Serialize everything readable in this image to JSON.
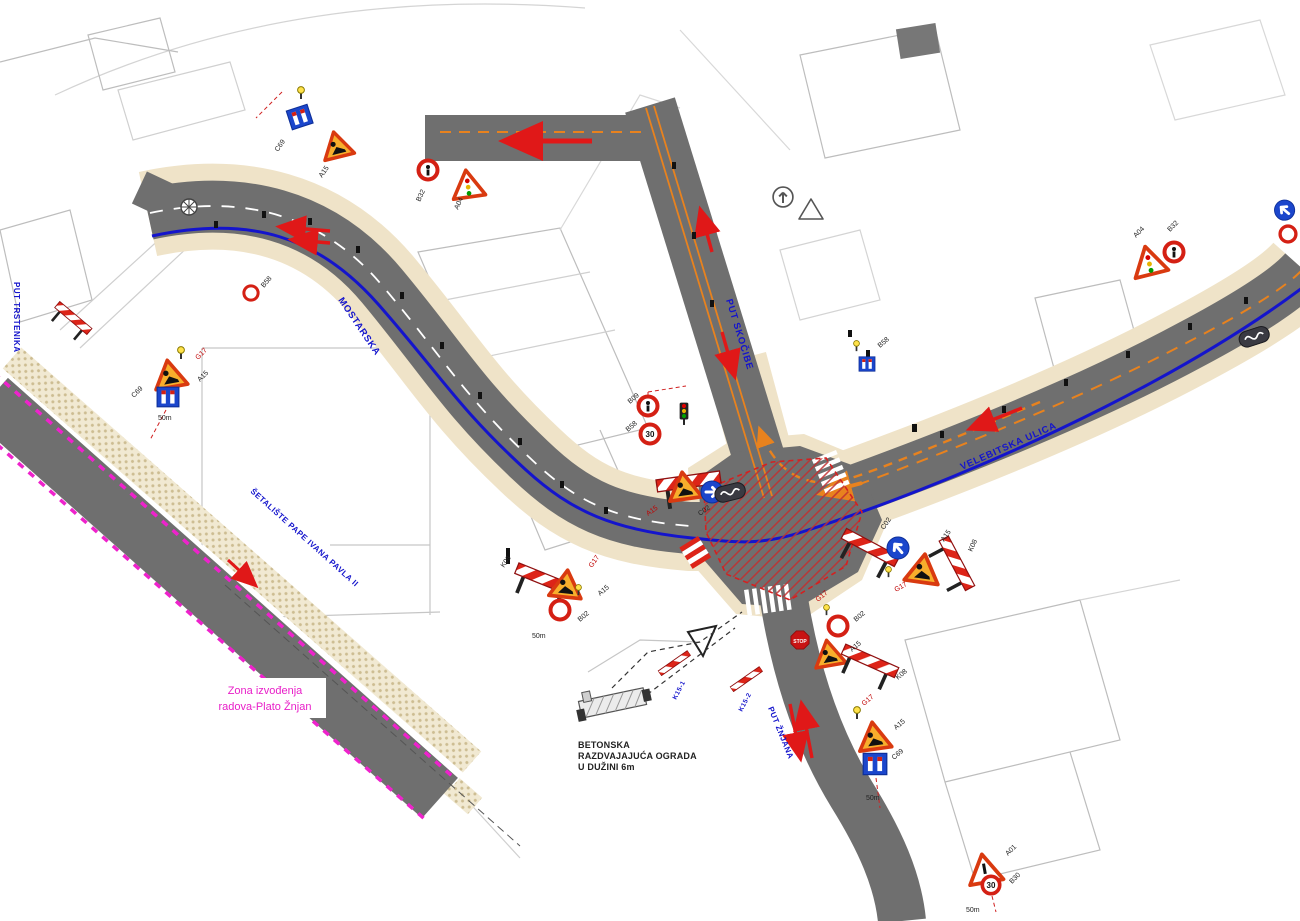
{
  "labels": {
    "zone_line1": "Zona izvođenja",
    "zone_line2": "radova-Plato Žnjan",
    "barrier_line1": "BETONSKA",
    "barrier_line2": "RAZDVAJAJUĆA OGRADA",
    "barrier_line3": "U DUŽINI 6m"
  },
  "streets": {
    "north": "PUT SKOČIBE",
    "east": "VELEBITSKA ULICA",
    "west": "MOSTARSKA",
    "south": "PUT ŽNJANA",
    "promenade": "ŠETALIŠTE PAPE IVANA PAVLA II",
    "left_edge": "PUT TRSTENIKA"
  },
  "codes": {
    "g17": "G17",
    "a15": "A15",
    "c69": "C69",
    "b30": "B30",
    "a01": "A01",
    "b32": "B32",
    "a04": "A04",
    "k08": "K08",
    "c02": "C02",
    "b58": "B58",
    "b09": "B09",
    "b02": "B02",
    "k15_1": "K15-1",
    "k15_2": "K15-2",
    "dist50": "50m",
    "stop": "STOP",
    "n30": "30"
  },
  "colors": {
    "road": "#6f6f6f",
    "sidewalk": "#efe3c8",
    "route_blue": "#1414cc",
    "guide_orange": "#e8821e",
    "arrow_red": "#e01818",
    "zone_magenta": "#ee22cc",
    "hatch_red": "#c03030"
  }
}
